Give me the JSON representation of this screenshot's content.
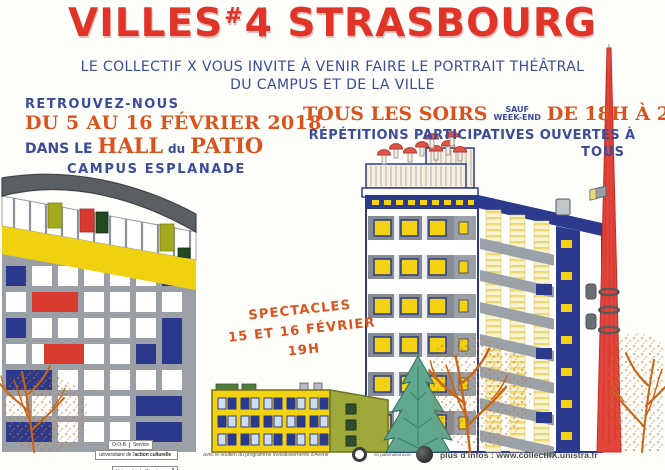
{
  "title": {
    "word1": "VILLES",
    "hash": "#",
    "number": "4",
    "word2": "STRASBOURG"
  },
  "subtitle": {
    "line1": "LE COLLECTIF X VOUS INVITE À VENIR FAIRE LE PORTRAIT THÉÂTRAL",
    "line2": "DU CAMPUS ET DE LA VILLE"
  },
  "left_block": {
    "line1": "RETROUVEZ-NOUS",
    "line2": "DU 5 AU 16 FÉVRIER 2018",
    "line3_pre": "DANS LE",
    "line3_hall": "HALL",
    "line3_du": "du",
    "line3_patio": "PATIO",
    "line4": "CAMPUS ESPLANADE"
  },
  "right_block": {
    "soirs": "TOUS LES SOIRS",
    "sauf": "SAUF",
    "weekend": "WEEK-END",
    "hours": "DE 18H À 20H",
    "line2": "RÉPÉTITIONS PARTICIPATIVES OUVERTES À",
    "line3": "TOUS"
  },
  "shows_block": {
    "line1": "SPECTACLES",
    "line2": "15 ET 16 FÉVRIER",
    "line3": "19H"
  },
  "footer": {
    "logo_cell1": "O-O-B",
    "logo_cell2": "Service",
    "logo_row2_pre": "universitaire de l'",
    "logo_row2_bold": "action culturelle",
    "logo_row3": "Université de Strasbourg",
    "support": "avec le soutien du programme Investissements d'Avenir",
    "partnership": "en partenariat avec",
    "info": "plus d'infos : www.collectifX.unistra.fr"
  },
  "palette": {
    "title_red": "#e13428",
    "text_blue": "#3c4c9b",
    "text_orange": "#d9531d",
    "yellow": "#f0d110",
    "navy": "#2b3a8d",
    "olive": "#9fa83a",
    "conifer_green": "#5fa78f",
    "facade_gray": "#9aa0a6",
    "tree_orange": "#c96519",
    "mast_red": "#e2453c"
  },
  "illustrations": [
    "mondrian-patio-building",
    "yellow-building",
    "conifer-tree",
    "residence-tower",
    "striped-tower",
    "red-antenna-mast",
    "bare-winter-trees"
  ]
}
